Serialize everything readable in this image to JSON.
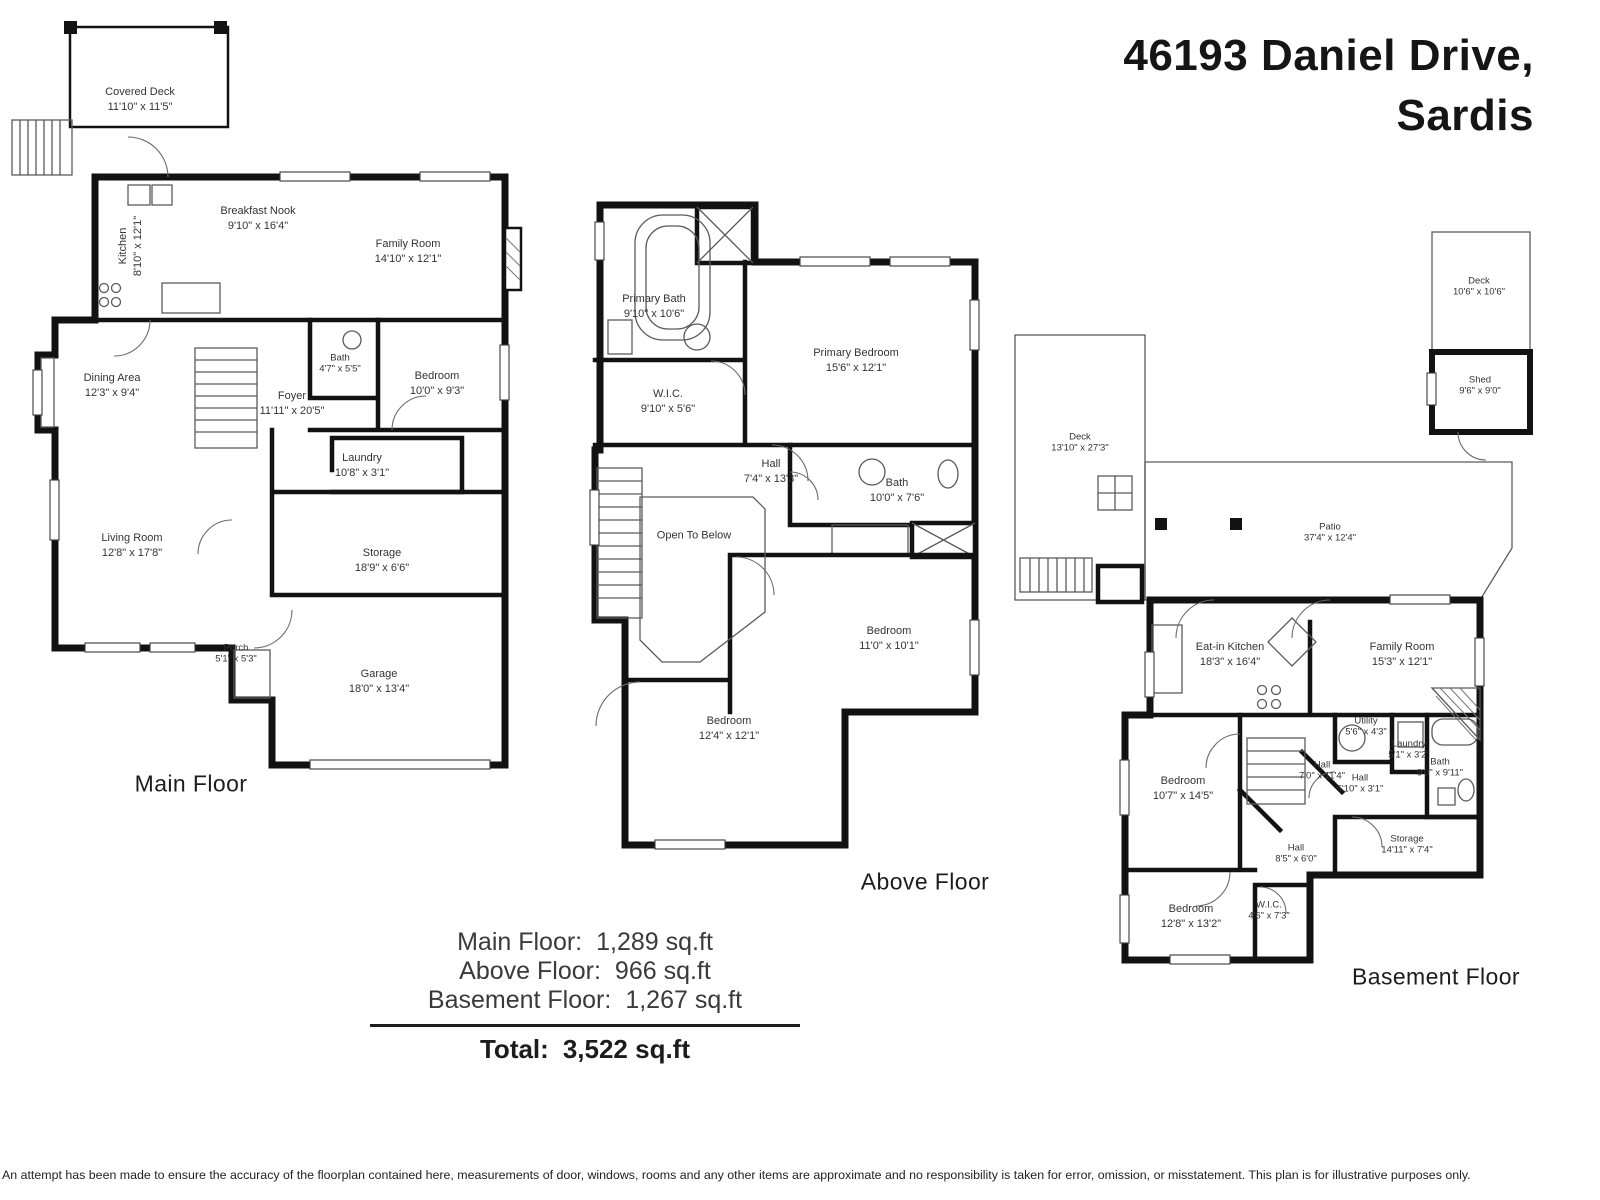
{
  "title": {
    "line1": "46193 Daniel Drive,",
    "line2": "Sardis"
  },
  "floors": [
    {
      "name": "Main Floor",
      "rooms": [
        {
          "name": "Covered Deck",
          "dims": "11'10\" x 11'5\""
        },
        {
          "name": "Kitchen",
          "dims": "8'10\" x 12'1\""
        },
        {
          "name": "Breakfast Nook",
          "dims": "9'10\" x 16'4\""
        },
        {
          "name": "Family Room",
          "dims": "14'10\" x 12'1\""
        },
        {
          "name": "Dining Area",
          "dims": "12'3\" x 9'4\""
        },
        {
          "name": "Foyer",
          "dims": "11'11\" x 20'5\""
        },
        {
          "name": "Bath",
          "dims": "4'7\" x 5'5\""
        },
        {
          "name": "Bedroom",
          "dims": "10'0\" x 9'3\""
        },
        {
          "name": "Laundry",
          "dims": "10'8\" x 3'1\""
        },
        {
          "name": "Living Room",
          "dims": "12'8\" x 17'8\""
        },
        {
          "name": "Storage",
          "dims": "18'9\" x 6'6\""
        },
        {
          "name": "Porch",
          "dims": "5'1\" x 5'3\""
        },
        {
          "name": "Garage",
          "dims": "18'0\" x 13'4\""
        }
      ]
    },
    {
      "name": "Above Floor",
      "rooms": [
        {
          "name": "Primary Bath",
          "dims": "9'10\" x 10'6\""
        },
        {
          "name": "W.I.C.",
          "dims": "9'10\" x 5'6\""
        },
        {
          "name": "Primary Bedroom",
          "dims": "15'6\" x 12'1\""
        },
        {
          "name": "Hall",
          "dims": "7'4\" x 13'3\""
        },
        {
          "name": "Bath",
          "dims": "10'0\" x 7'6\""
        },
        {
          "name": "Open To Below",
          "dims": ""
        },
        {
          "name": "Bedroom",
          "dims": "11'0\" x 10'1\""
        },
        {
          "name": "Bedroom",
          "dims": "12'4\" x 12'1\""
        }
      ]
    },
    {
      "name": "Basement Floor",
      "rooms": [
        {
          "name": "Deck",
          "dims": "10'6\" x 10'6\""
        },
        {
          "name": "Shed",
          "dims": "9'6\" x 9'0\""
        },
        {
          "name": "Deck",
          "dims": "13'10\" x 27'3\""
        },
        {
          "name": "Patio",
          "dims": "37'4\" x 12'4\""
        },
        {
          "name": "Eat-in Kitchen",
          "dims": "18'3\" x 16'4\""
        },
        {
          "name": "Family Room",
          "dims": "15'3\" x 12'1\""
        },
        {
          "name": "Utility",
          "dims": "5'6\" x 4'3\""
        },
        {
          "name": "Laundry",
          "dims": "5'1\" x 3'2\""
        },
        {
          "name": "Bath",
          "dims": "9'0\" x 9'11\""
        },
        {
          "name": "Hall",
          "dims": "7'0\" x 11'4\""
        },
        {
          "name": "Hall",
          "dims": "5'10\" x 3'1\""
        },
        {
          "name": "Bedroom",
          "dims": "10'7\" x 14'5\""
        },
        {
          "name": "Hall",
          "dims": "8'5\" x 6'0\""
        },
        {
          "name": "Storage",
          "dims": "14'11\" x 7'4\""
        },
        {
          "name": "Bedroom",
          "dims": "12'8\" x 13'2\""
        },
        {
          "name": "W.I.C.",
          "dims": "4'6\" x 7'3\""
        }
      ]
    }
  ],
  "summary": {
    "rows": [
      {
        "label": "Main Floor:",
        "value": "1,289 sq.ft"
      },
      {
        "label": "Above Floor:",
        "value": "966 sq.ft"
      },
      {
        "label": "Basement Floor:",
        "value": "1,267 sq.ft"
      }
    ],
    "total": {
      "label": "Total:",
      "value": "3,522 sq.ft"
    }
  },
  "disclaimer": "An attempt has been made to ensure the accuracy of the floorplan contained here, measurements of door, windows, rooms and any other items are approximate and no responsibility is taken for error, omission, or misstatement. This plan is for illustrative purposes only."
}
